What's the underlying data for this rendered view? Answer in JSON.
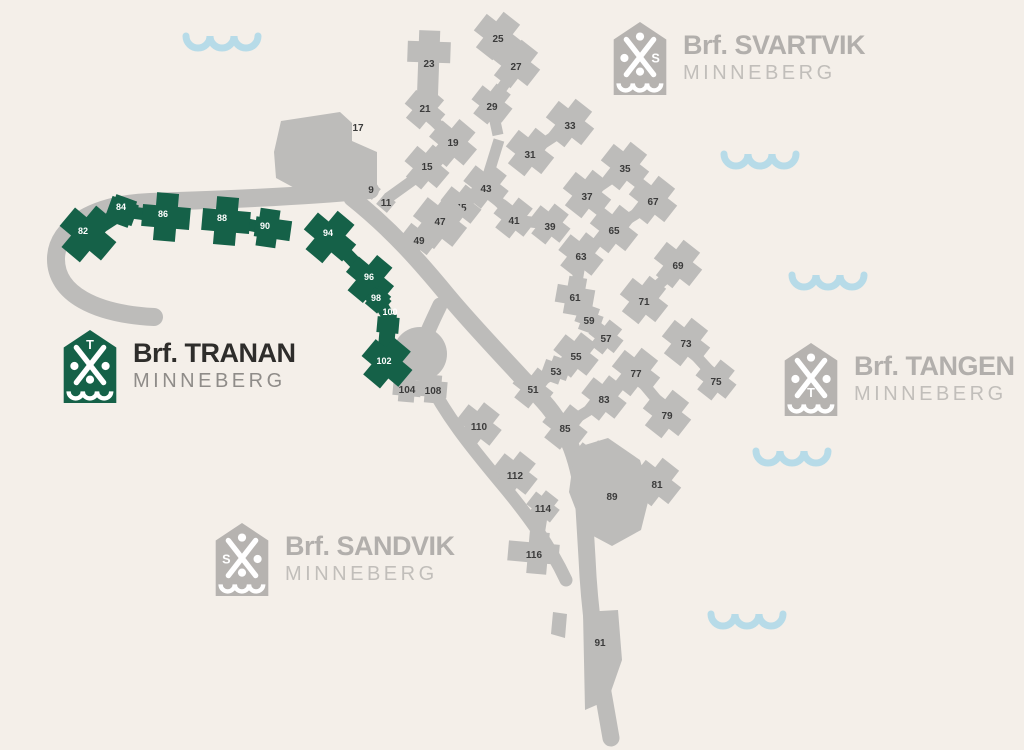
{
  "palette": {
    "background": "#f4efe9",
    "road": "#bdbcba",
    "building_gray": "#bdbcba",
    "building_green": "#156148",
    "wave": "#b7dbe8",
    "label_on_gray": "#3b3b3b",
    "label_on_green": "#ffffff",
    "logo_glyph": "#ffffff"
  },
  "logos": [
    {
      "id": "svartvik",
      "prefix": "Brf.",
      "name": "SVARTVIK",
      "place": "MINNEBERG",
      "letter": "S",
      "letter_slot": "e",
      "shield_color": "#b6b3b0",
      "brand_color": "#b2afac",
      "place_color": "#c1beba"
    },
    {
      "id": "tranan",
      "prefix": "Brf.",
      "name": "TRANAN",
      "place": "MINNEBERG",
      "letter": "T",
      "letter_slot": "n",
      "shield_color": "#156148",
      "brand_color": "#2e2d2b",
      "place_color": "#8f8c89"
    },
    {
      "id": "tangen",
      "prefix": "Brf.",
      "name": "TANGEN",
      "place": "MINNEBERG",
      "letter": "T",
      "letter_slot": "s",
      "shield_color": "#b6b3b0",
      "brand_color": "#b2afac",
      "place_color": "#c1beba"
    },
    {
      "id": "sandvik",
      "prefix": "Brf.",
      "name": "SANDVIK",
      "place": "MINNEBERG",
      "letter": "S",
      "letter_slot": "w",
      "shield_color": "#b6b3b0",
      "brand_color": "#b2afac",
      "place_color": "#c1beba"
    }
  ],
  "map": {
    "roads": [
      {
        "d": "M370 190C300 197 210 200 150 202C95 204 57 226 56 258C55 294 96 314 154 317",
        "w": 18
      },
      {
        "d": "M352 198C392 230 420 262 448 296C478 332 512 366 544 402C570 431 581 468 584 508L587 558C589 604 595 650 604 698L611 738",
        "w": 17
      },
      {
        "d": "M440 305C432 322 426 334 423 344",
        "w": 15
      },
      {
        "d": "M424 372C444 414 471 447 501 483C527 514 549 544 566 580",
        "w": 13
      }
    ],
    "culdesac": {
      "cx": 420,
      "cy": 354,
      "r": 27
    },
    "gray_connectors": [
      [
        429,
        72,
        425,
        105
      ],
      [
        425,
        112,
        453,
        140
      ],
      [
        453,
        146,
        427,
        164
      ],
      [
        427,
        170,
        388,
        198
      ],
      [
        498,
        40,
        516,
        62
      ],
      [
        516,
        68,
        492,
        102
      ],
      [
        570,
        126,
        530,
        152
      ],
      [
        625,
        169,
        587,
        195
      ],
      [
        653,
        203,
        614,
        228
      ],
      [
        581,
        258,
        575,
        294
      ],
      [
        575,
        299,
        589,
        317
      ],
      [
        589,
        321,
        606,
        335
      ],
      [
        678,
        267,
        644,
        298
      ],
      [
        686,
        345,
        716,
        378
      ],
      [
        636,
        375,
        667,
        412
      ],
      [
        576,
        358,
        556,
        369
      ],
      [
        556,
        372,
        533,
        386
      ],
      [
        604,
        401,
        565,
        425
      ],
      [
        593,
        466,
        610,
        490
      ],
      [
        486,
        189,
        514,
        217
      ],
      [
        514,
        220,
        548,
        224
      ],
      [
        461,
        208,
        440,
        220
      ],
      [
        440,
        224,
        419,
        238
      ],
      [
        486,
        182,
        499,
        140
      ],
      [
        492,
        107,
        498,
        135
      ],
      [
        407,
        390,
        433,
        390
      ],
      [
        543,
        510,
        537,
        548
      ]
    ],
    "green_connectors": [
      [
        88,
        234,
        122,
        212,
        15
      ],
      [
        128,
        212,
        158,
        216,
        12
      ],
      [
        234,
        222,
        260,
        227,
        12
      ],
      [
        334,
        241,
        368,
        276,
        13
      ],
      [
        372,
        283,
        378,
        297,
        11
      ],
      [
        380,
        303,
        388,
        316,
        13
      ]
    ],
    "gray_buildings": [
      {
        "n": "9",
        "x": 371,
        "y": 190,
        "r": 40,
        "s": 14,
        "a": [
          0,
          0,
          0,
          0
        ]
      },
      {
        "n": "11",
        "x": 386,
        "y": 203,
        "r": 40,
        "s": 14,
        "a": [
          0,
          0,
          0,
          0
        ]
      },
      {
        "n": "15",
        "x": 427,
        "y": 167,
        "r": 40,
        "s": 20,
        "a": [
          11,
          11,
          11,
          11
        ]
      },
      {
        "n": "17",
        "poly": "M274 152L281 121L340 112L352 123L352 141L377 152L377 186L300 191L276 178Z",
        "lx": 358,
        "ly": 128
      },
      {
        "n": "19",
        "x": 453,
        "y": 143,
        "r": 40,
        "s": 21,
        "a": [
          12,
          12,
          12,
          12
        ]
      },
      {
        "n": "21",
        "x": 425,
        "y": 109,
        "r": 40,
        "s": 18,
        "a": [
          10,
          10,
          10,
          10
        ]
      },
      {
        "n": "23",
        "x": 429,
        "y": 52,
        "r": 2,
        "s": 21,
        "a": [
          11,
          11,
          40,
          11
        ],
        "lx": 429,
        "ly": 64
      },
      {
        "n": "25",
        "x": 498,
        "y": 36,
        "r": 38,
        "s": 21,
        "a": [
          12,
          12,
          12,
          12
        ],
        "ly": 39
      },
      {
        "n": "27",
        "x": 516,
        "y": 64,
        "r": 38,
        "s": 21,
        "a": [
          12,
          12,
          12,
          12
        ],
        "ly": 67
      },
      {
        "n": "29",
        "x": 492,
        "y": 104,
        "r": 38,
        "s": 18,
        "a": [
          10,
          10,
          10,
          10
        ],
        "ly": 107
      },
      {
        "n": "31",
        "x": 530,
        "y": 152,
        "r": 38,
        "s": 21,
        "a": [
          12,
          12,
          12,
          12
        ],
        "ly": 155
      },
      {
        "n": "33",
        "x": 570,
        "y": 123,
        "r": 38,
        "s": 21,
        "a": [
          12,
          12,
          12,
          12
        ],
        "ly": 126
      },
      {
        "n": "35",
        "x": 625,
        "y": 166,
        "r": 38,
        "s": 21,
        "a": [
          12,
          12,
          12,
          12
        ],
        "ly": 169
      },
      {
        "n": "37",
        "x": 587,
        "y": 194,
        "r": 38,
        "s": 21,
        "a": [
          12,
          12,
          12,
          12
        ],
        "ly": 197
      },
      {
        "n": "39",
        "x": 550,
        "y": 224,
        "r": 38,
        "s": 18,
        "a": [
          10,
          10,
          10,
          10
        ],
        "ly": 227
      },
      {
        "n": "41",
        "x": 514,
        "y": 218,
        "r": 38,
        "s": 18,
        "a": [
          10,
          10,
          10,
          10
        ],
        "ly": 221
      },
      {
        "n": "43",
        "x": 486,
        "y": 186,
        "r": 38,
        "s": 20,
        "a": [
          11,
          11,
          11,
          11
        ],
        "ly": 189
      },
      {
        "n": "45",
        "x": 461,
        "y": 205,
        "r": 38,
        "s": 18,
        "a": [
          10,
          10,
          10,
          10
        ],
        "ly": 208
      },
      {
        "n": "47",
        "x": 440,
        "y": 222,
        "r": 38,
        "s": 24,
        "a": [
          13,
          13,
          13,
          13
        ]
      },
      {
        "n": "49",
        "x": 419,
        "y": 239,
        "r": 38,
        "s": 16,
        "a": [
          8,
          8,
          8,
          8
        ],
        "ly": 241
      },
      {
        "n": "51",
        "x": 533,
        "y": 388,
        "r": 38,
        "s": 18,
        "a": [
          10,
          10,
          10,
          10
        ],
        "ly": 390
      },
      {
        "n": "53",
        "x": 556,
        "y": 370,
        "r": 20,
        "s": 14,
        "a": [
          6,
          6,
          6,
          6
        ],
        "ly": 372
      },
      {
        "n": "55",
        "x": 576,
        "y": 355,
        "r": 38,
        "s": 20,
        "a": [
          11,
          11,
          11,
          11
        ],
        "ly": 357
      },
      {
        "n": "57",
        "x": 606,
        "y": 337,
        "r": 38,
        "s": 16,
        "a": [
          8,
          8,
          8,
          8
        ],
        "ly": 339
      },
      {
        "n": "59",
        "x": 589,
        "y": 319,
        "r": 20,
        "s": 14,
        "a": [
          6,
          6,
          6,
          6
        ],
        "ly": 321
      },
      {
        "n": "61",
        "x": 575,
        "y": 296,
        "r": 10,
        "s": 18,
        "a": [
          10,
          10,
          10,
          10
        ],
        "ly": 298
      },
      {
        "n": "63",
        "x": 581,
        "y": 255,
        "r": 38,
        "s": 20,
        "a": [
          11,
          11,
          11,
          11
        ],
        "ly": 257
      },
      {
        "n": "65",
        "x": 614,
        "y": 229,
        "r": 38,
        "s": 21,
        "a": [
          12,
          12,
          12,
          12
        ],
        "ly": 231
      },
      {
        "n": "67",
        "x": 653,
        "y": 200,
        "r": 38,
        "s": 21,
        "a": [
          12,
          12,
          12,
          12
        ],
        "ly": 202
      },
      {
        "n": "69",
        "x": 678,
        "y": 264,
        "r": 38,
        "s": 21,
        "a": [
          12,
          12,
          12,
          12
        ],
        "ly": 266
      },
      {
        "n": "71",
        "x": 644,
        "y": 300,
        "r": 38,
        "s": 21,
        "a": [
          12,
          12,
          12,
          12
        ],
        "ly": 302
      },
      {
        "n": "73",
        "x": 686,
        "y": 342,
        "r": 38,
        "s": 21,
        "a": [
          12,
          12,
          12,
          12
        ],
        "ly": 344
      },
      {
        "n": "75",
        "x": 716,
        "y": 380,
        "r": 38,
        "s": 18,
        "a": [
          10,
          10,
          10,
          10
        ],
        "ly": 382
      },
      {
        "n": "77",
        "x": 636,
        "y": 372,
        "r": 38,
        "s": 21,
        "a": [
          12,
          12,
          12,
          12
        ],
        "ly": 374
      },
      {
        "n": "79",
        "x": 667,
        "y": 414,
        "r": 38,
        "s": 21,
        "a": [
          12,
          12,
          12,
          12
        ],
        "ly": 416
      },
      {
        "n": "81",
        "x": 657,
        "y": 482,
        "r": 38,
        "s": 21,
        "a": [
          12,
          12,
          12,
          12
        ],
        "ly": 485
      },
      {
        "n": "83",
        "x": 604,
        "y": 398,
        "r": 38,
        "s": 20,
        "a": [
          11,
          11,
          11,
          11
        ],
        "ly": 400
      },
      {
        "n": "85",
        "x": 565,
        "y": 427,
        "r": 38,
        "s": 20,
        "a": [
          11,
          11,
          11,
          11
        ],
        "ly": 429
      },
      {
        "n": "87",
        "x": 593,
        "y": 463,
        "r": 38,
        "s": 20,
        "a": [
          11,
          11,
          11,
          11
        ],
        "ly": 465
      },
      {
        "n": "89",
        "poly": "M575 448L608 438L640 460L650 494L641 530L612 546L584 531L569 492Z",
        "lx": 612,
        "ly": 497
      },
      {
        "n": "91",
        "poly": "M583 612L618 610L622 660L608 700L585 710Z",
        "lx": 600,
        "ly": 643
      },
      {
        "n": "",
        "poly": "M553 612L567 614L565 638L551 634Z"
      },
      {
        "n": "104",
        "x": 407,
        "y": 388,
        "r": 5,
        "s": 16,
        "a": [
          6,
          6,
          6,
          6
        ],
        "ly": 390
      },
      {
        "n": "108",
        "x": 433,
        "y": 389,
        "r": 5,
        "s": 16,
        "a": [
          6,
          6,
          6,
          6
        ],
        "ly": 391
      },
      {
        "n": "110",
        "x": 479,
        "y": 425,
        "r": 38,
        "s": 20,
        "a": [
          11,
          11,
          11,
          11
        ],
        "ly": 427
      },
      {
        "n": "112",
        "x": 515,
        "y": 474,
        "r": 38,
        "s": 20,
        "a": [
          11,
          11,
          11,
          11
        ],
        "ly": 476
      },
      {
        "n": "114",
        "x": 543,
        "y": 507,
        "r": 38,
        "s": 16,
        "a": [
          7,
          7,
          7,
          7
        ],
        "ly": 509
      },
      {
        "n": "116",
        "x": 538,
        "y": 553,
        "r": 5,
        "s": 20,
        "a": [
          11,
          11,
          11,
          20
        ],
        "lx": 534,
        "ly": 555
      }
    ],
    "green_buildings": [
      {
        "n": "82",
        "x": 88,
        "y": 234,
        "r": 40,
        "s": 24,
        "a": [
          15,
          15,
          15,
          15
        ],
        "lx": 83,
        "ly": 231
      },
      {
        "n": "84",
        "x": 122,
        "y": 211,
        "r": 20,
        "s": 22,
        "a": [
          3,
          3,
          3,
          3
        ],
        "lx": 121,
        "ly": 207
      },
      {
        "n": "86",
        "x": 166,
        "y": 217,
        "r": 5,
        "s": 22,
        "a": [
          13,
          13,
          13,
          13
        ],
        "lx": 163,
        "ly": 214
      },
      {
        "n": "88",
        "x": 226,
        "y": 221,
        "r": 5,
        "s": 22,
        "a": [
          13,
          13,
          13,
          13
        ],
        "lx": 222,
        "ly": 218
      },
      {
        "n": "90",
        "x": 268,
        "y": 228,
        "r": 8,
        "s": 20,
        "a": [
          9,
          13,
          9,
          3
        ],
        "lx": 265,
        "ly": 226
      },
      {
        "n": "94",
        "x": 330,
        "y": 237,
        "r": 40,
        "s": 22,
        "a": [
          14,
          14,
          14,
          14
        ],
        "lx": 328,
        "ly": 233
      },
      {
        "n": "96",
        "x": 370,
        "y": 279,
        "r": 40,
        "s": 20,
        "a": [
          13,
          13,
          13,
          13
        ],
        "lx": 369,
        "ly": 277
      },
      {
        "n": "98",
        "x": 378,
        "y": 300,
        "r": 40,
        "s": 16,
        "a": [
          3,
          3,
          3,
          3
        ],
        "lx": 376,
        "ly": 298
      },
      {
        "n": "100",
        "x": 388,
        "y": 325,
        "r": 5,
        "s": 16,
        "a": [
          3,
          3,
          18,
          3
        ],
        "lx": 390,
        "ly": 312
      },
      {
        "n": "102",
        "x": 387,
        "y": 363,
        "r": 40,
        "s": 22,
        "a": [
          13,
          13,
          13,
          13
        ],
        "lx": 384,
        "ly": 361
      }
    ],
    "waves": [
      {
        "x": 222,
        "y": 36
      },
      {
        "x": 760,
        "y": 154
      },
      {
        "x": 828,
        "y": 275
      },
      {
        "x": 792,
        "y": 451
      },
      {
        "x": 747,
        "y": 614
      }
    ]
  }
}
